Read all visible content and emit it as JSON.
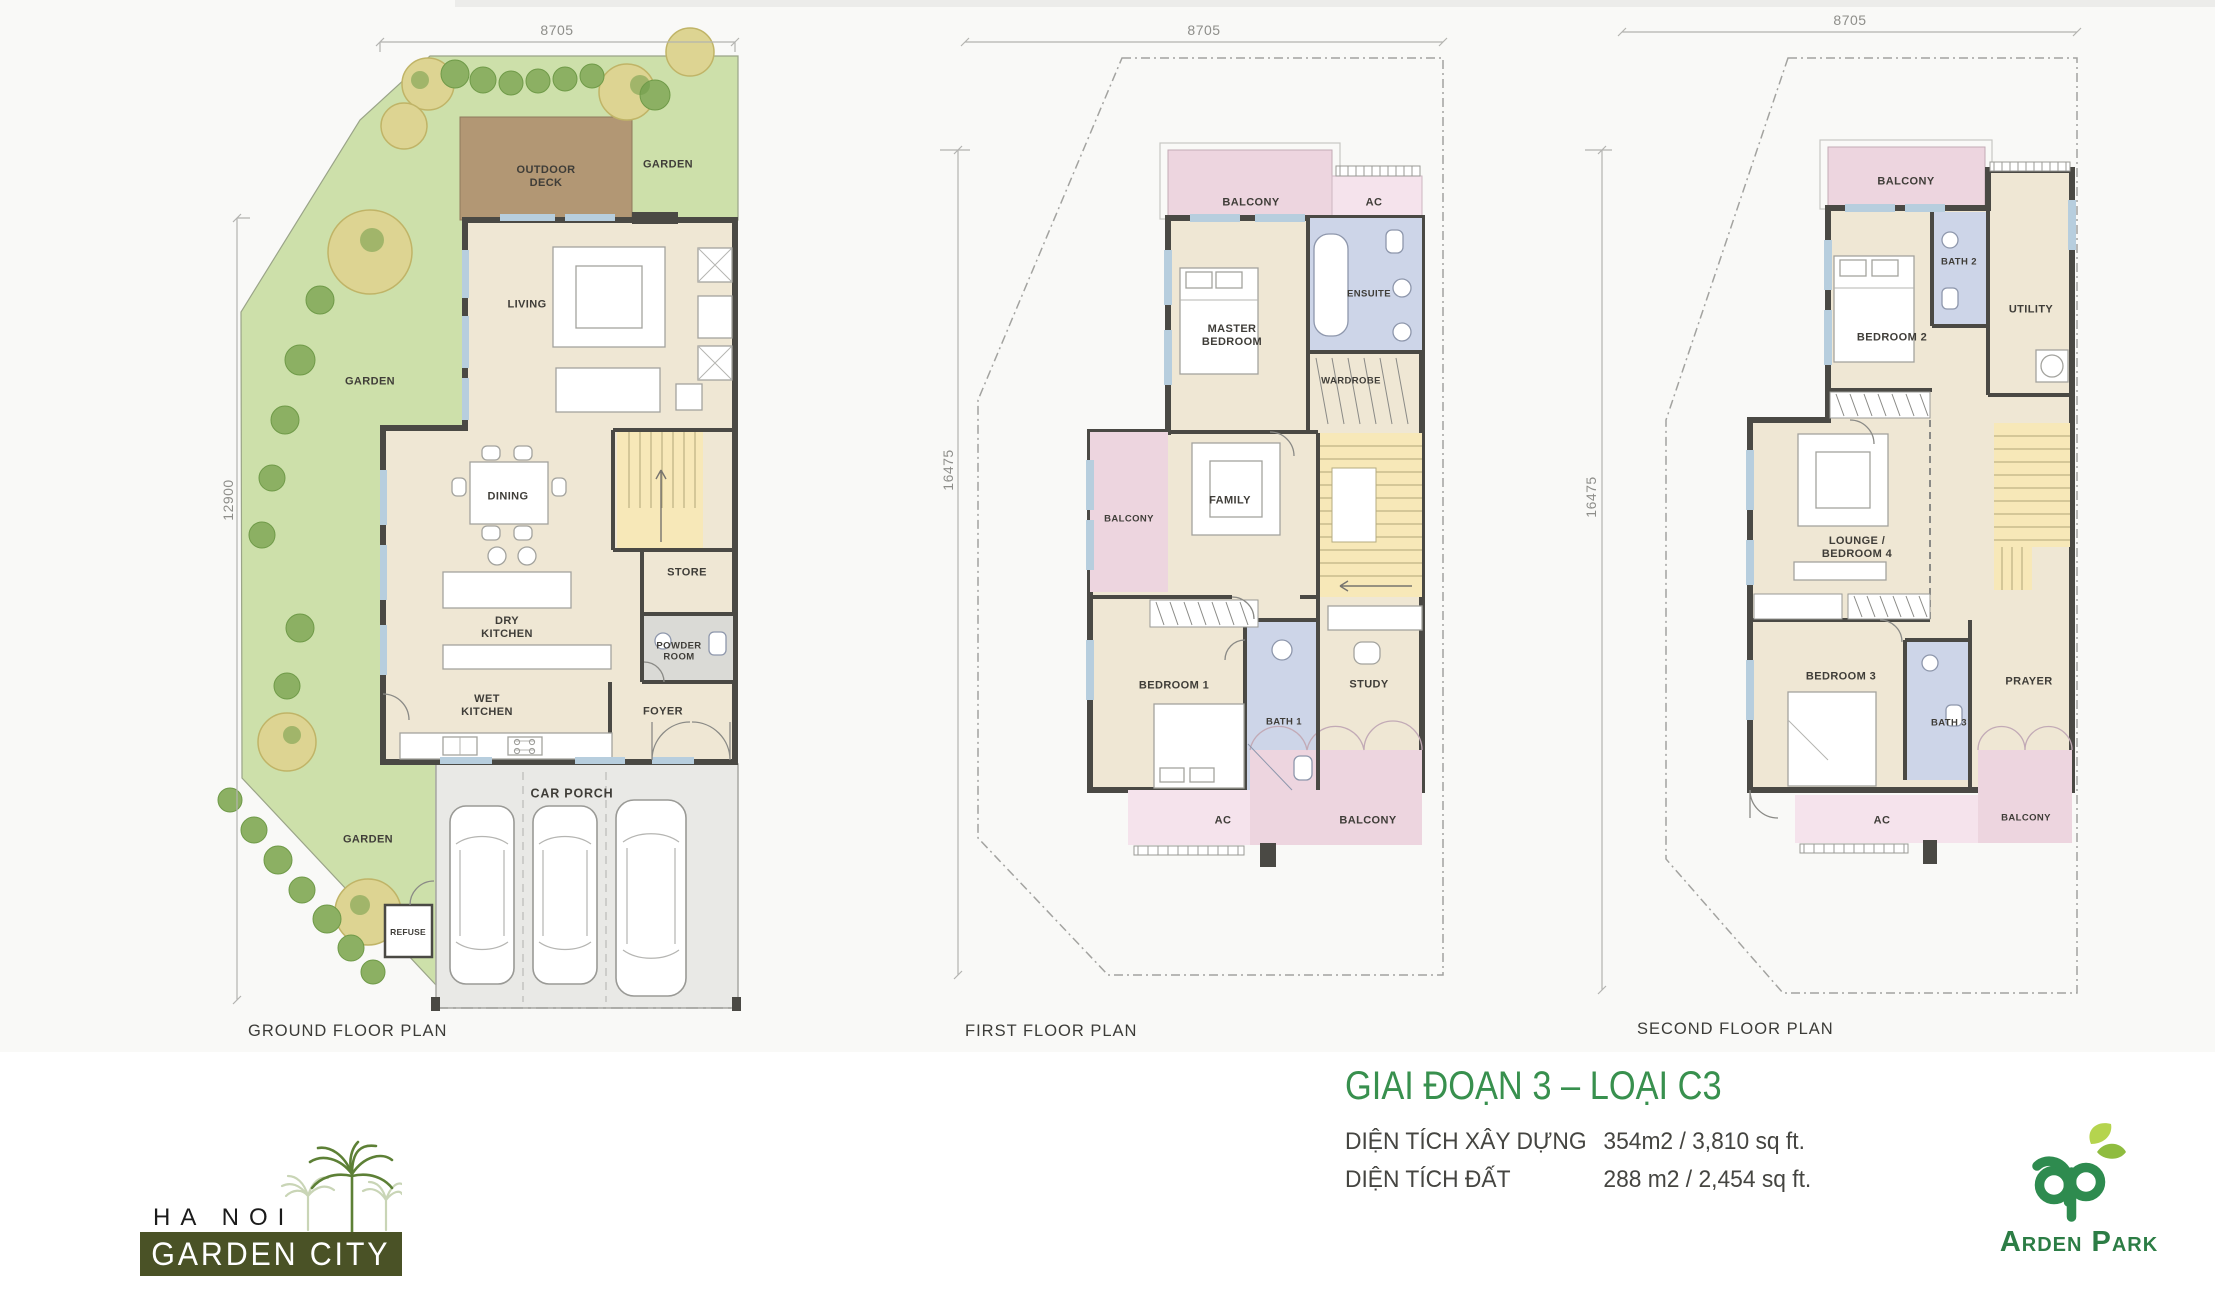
{
  "plans": [
    {
      "caption": "GROUND FLOOR PLAN",
      "dims": {
        "top": "8705",
        "left": "12900"
      },
      "rooms": [
        {
          "label": "OUTDOOR\nDECK"
        },
        {
          "label": "GARDEN"
        },
        {
          "label": "GARDEN"
        },
        {
          "label": "GARDEN"
        },
        {
          "label": "LIVING"
        },
        {
          "label": "DINING"
        },
        {
          "label": "DRY\nKITCHEN"
        },
        {
          "label": "WET\nKITCHEN"
        },
        {
          "label": "STORE"
        },
        {
          "label": "POWDER\nROOM"
        },
        {
          "label": "FOYER"
        },
        {
          "label": "CAR PORCH"
        },
        {
          "label": "REFUSE"
        }
      ]
    },
    {
      "caption": "FIRST FLOOR PLAN",
      "dims": {
        "top": "8705",
        "left": "16475"
      },
      "rooms": [
        {
          "label": "BALCONY"
        },
        {
          "label": "AC"
        },
        {
          "label": "MASTER\nBEDROOM"
        },
        {
          "label": "ENSUITE"
        },
        {
          "label": "WARDROBE"
        },
        {
          "label": "BALCONY"
        },
        {
          "label": "FAMILY"
        },
        {
          "label": "BEDROOM 1"
        },
        {
          "label": "BATH 1"
        },
        {
          "label": "STUDY"
        },
        {
          "label": "AC"
        },
        {
          "label": "BALCONY"
        }
      ]
    },
    {
      "caption": "SECOND FLOOR PLAN",
      "dims": {
        "top": "8705",
        "left": "16475"
      },
      "rooms": [
        {
          "label": "BALCONY"
        },
        {
          "label": "BEDROOM 2"
        },
        {
          "label": "BATH 2"
        },
        {
          "label": "UTILITY"
        },
        {
          "label": "LOUNGE /\nBEDROOM 4"
        },
        {
          "label": "BEDROOM 3"
        },
        {
          "label": "BATH 3"
        },
        {
          "label": "PRAYER"
        },
        {
          "label": "AC"
        },
        {
          "label": "BALCONY"
        }
      ]
    }
  ],
  "title_block": {
    "title": "GIAI ĐOẠN 3 – LOẠI C3",
    "rows": [
      {
        "label": "DIỆN TÍCH XÂY DỰNG",
        "value": "354m2 / 3,810 sq ft."
      },
      {
        "label": "DIỆN TÍCH ĐẤT",
        "value": "288 m2 / 2,454 sq ft."
      }
    ]
  },
  "logos": {
    "hanoi": {
      "top": "HA NOI",
      "bottom": "GARDEN CITY",
      "icon": "palm-trees-icon"
    },
    "arden": {
      "name": "Arden Park",
      "icon": "ap-leaf-monogram-icon"
    }
  },
  "colors": {
    "floor": "#efe7d4",
    "deck": "#b29774",
    "garden": "#cde0aa",
    "balcony_pink": "#edd5df",
    "ac_pink": "#f5e3ec",
    "bath_blue": "#cdd5e8",
    "stairs_yellow": "#f7e8b8",
    "walls": "#4a4944",
    "title_green": "#38904e",
    "hanoi_olive": "#4a5226",
    "arden_green": "#2e8b4f"
  }
}
